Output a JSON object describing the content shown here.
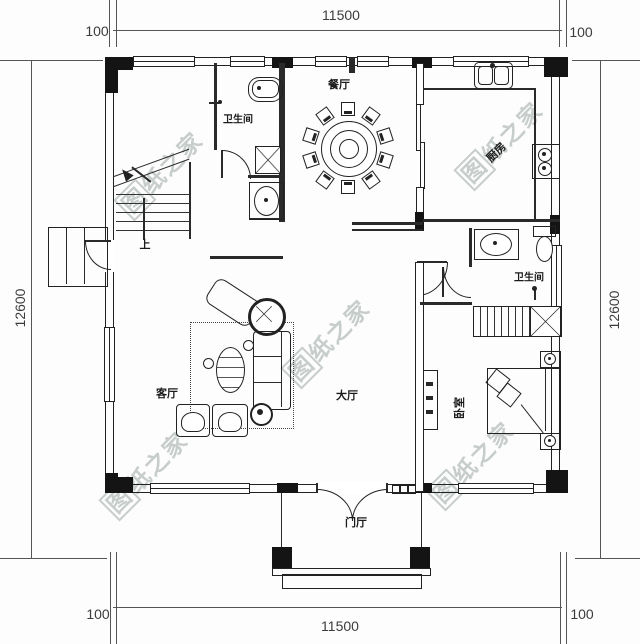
{
  "title": "residential-floor-plan",
  "rooms": {
    "dining": {
      "label": "餐厅"
    },
    "bath1": {
      "label": "卫生间"
    },
    "kitchen": {
      "label": "厨房"
    },
    "bath2": {
      "label": "卫生间"
    },
    "living": {
      "label": "客厅"
    },
    "hall": {
      "label": "大厅"
    },
    "bedroom": {
      "label": "卧室"
    },
    "entry": {
      "label": "门厅"
    },
    "stairs_up": {
      "label": "上"
    }
  },
  "dimensions": {
    "top_total": "11500",
    "top_left": "100",
    "top_right": "100",
    "bottom_total": "11500",
    "bottom_left": "100",
    "bottom_right": "100",
    "left_total": "12600",
    "right_total": "12600"
  },
  "watermark": {
    "first": "图",
    "rest": "纸之家",
    "color": "#7a8a82"
  },
  "colors": {
    "line": "#222222",
    "wall_fill": "#141414",
    "background": "#ffffff"
  }
}
